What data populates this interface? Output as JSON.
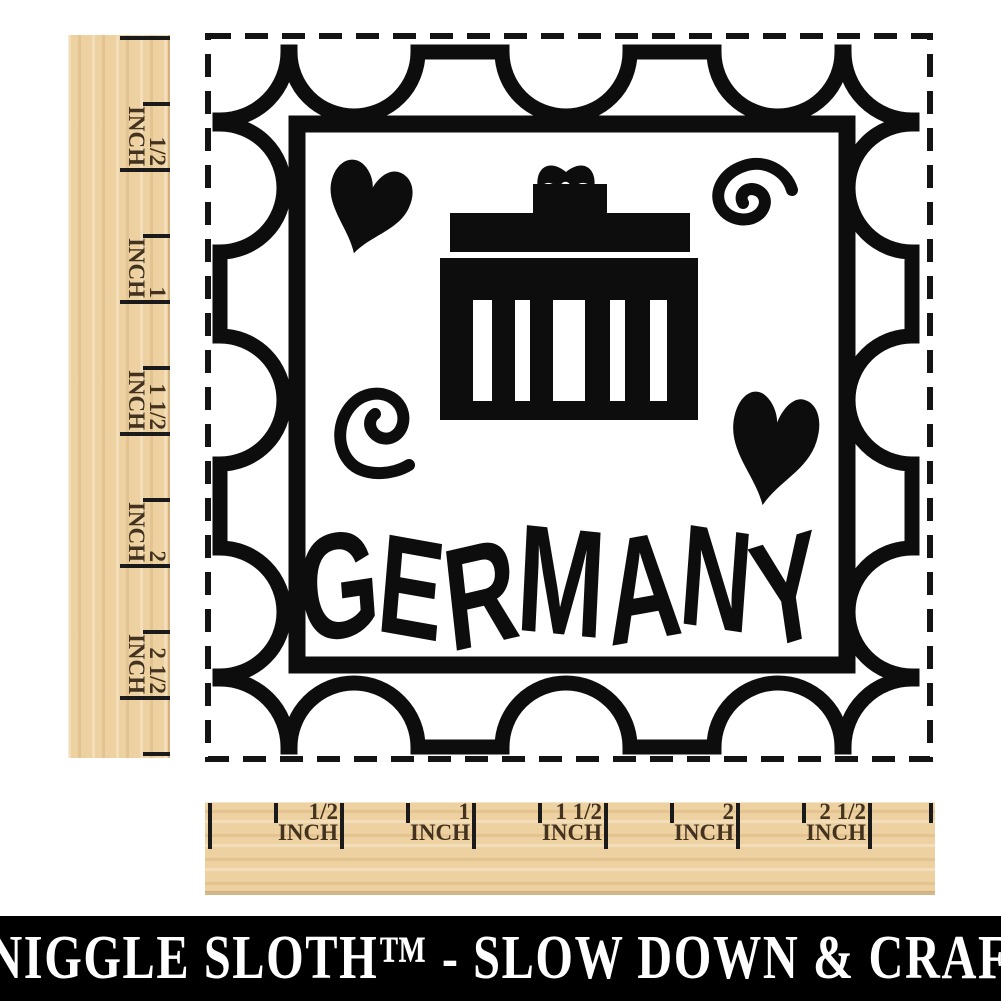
{
  "title": "Germany travel rubber stamp with Brandenburg Gate",
  "stamp": {
    "country_label": "GERMANY",
    "icons": [
      "brandenburg-gate-icon",
      "heart-icon-top-left",
      "swirl-icon-top-right",
      "swirl-icon-left",
      "heart-icon-right"
    ]
  },
  "rulers": {
    "unit": "INCH",
    "labels": [
      "1/2",
      "1",
      "1 1/2",
      "2",
      "2 1/2"
    ]
  },
  "banner": {
    "text": "SNIGGLE SLOTH™ - SLOW DOWN & CRAFT"
  },
  "colors": {
    "ink": "#0d0d0d",
    "wood": "#edd1a0",
    "ruler_text": "#43321f",
    "banner_bg": "#000000",
    "banner_text": "#ffffff",
    "page_bg": "#ffffff"
  }
}
